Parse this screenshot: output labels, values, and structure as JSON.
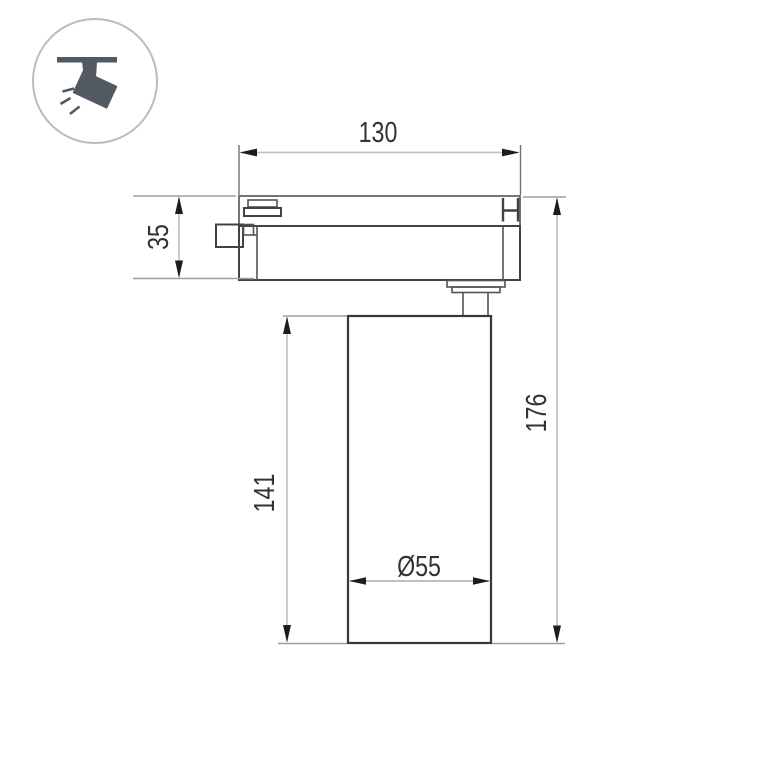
{
  "drawing": {
    "type": "technical-dimension-drawing",
    "subject": "track-mounted cylindrical spotlight, side view",
    "dims": {
      "width": "130",
      "adapter_height": "35",
      "head_height": "141",
      "total_height": "176",
      "diameter": "Ø55"
    }
  },
  "icon": {
    "name": "track-spotlight-pictogram",
    "description": "circled pictogram of a spotlight hanging from a ceiling track emitting light rays"
  },
  "colors": {
    "background": "#ffffff",
    "object_line": "#3f4346",
    "dimension_line": "#c4c4c4",
    "extension_line": "#9e9e9e",
    "arrow": "#1d1d1d",
    "text": "#333333",
    "icon_shape": "#525960",
    "icon_circle_stroke": "#b9bdc1"
  }
}
